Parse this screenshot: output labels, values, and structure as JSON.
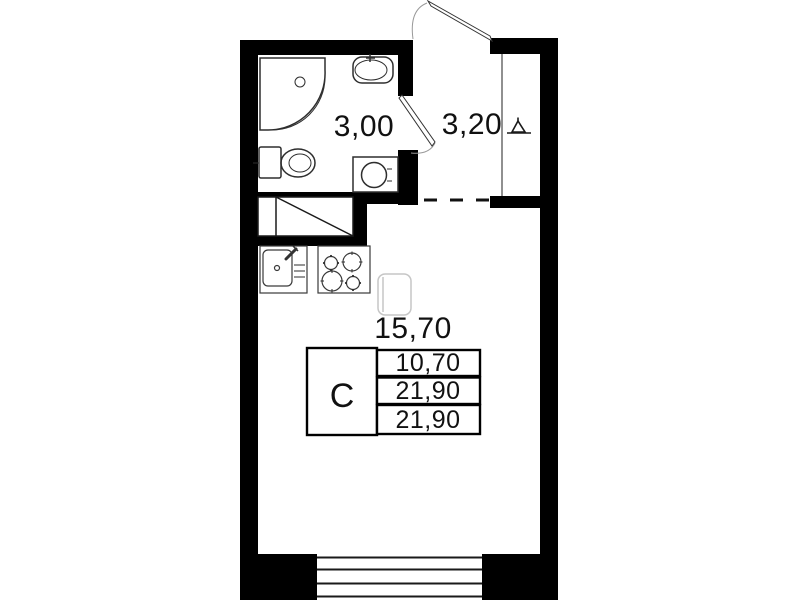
{
  "plan_labels": {
    "rooms": [
      {
        "name": "bathroom",
        "area": "3,00"
      },
      {
        "name": "hallway",
        "area": "3,20"
      },
      {
        "name": "living-kitchen",
        "area": "15,70"
      }
    ],
    "summary_table": {
      "unit_type": "С",
      "rows": [
        "10,70",
        "21,90",
        "21,90"
      ]
    }
  },
  "colors": {
    "wall": "#000000",
    "fixture": "#2e2e2e",
    "faint": "#c6c6c6",
    "text": "#111111",
    "background": "#ffffff"
  }
}
